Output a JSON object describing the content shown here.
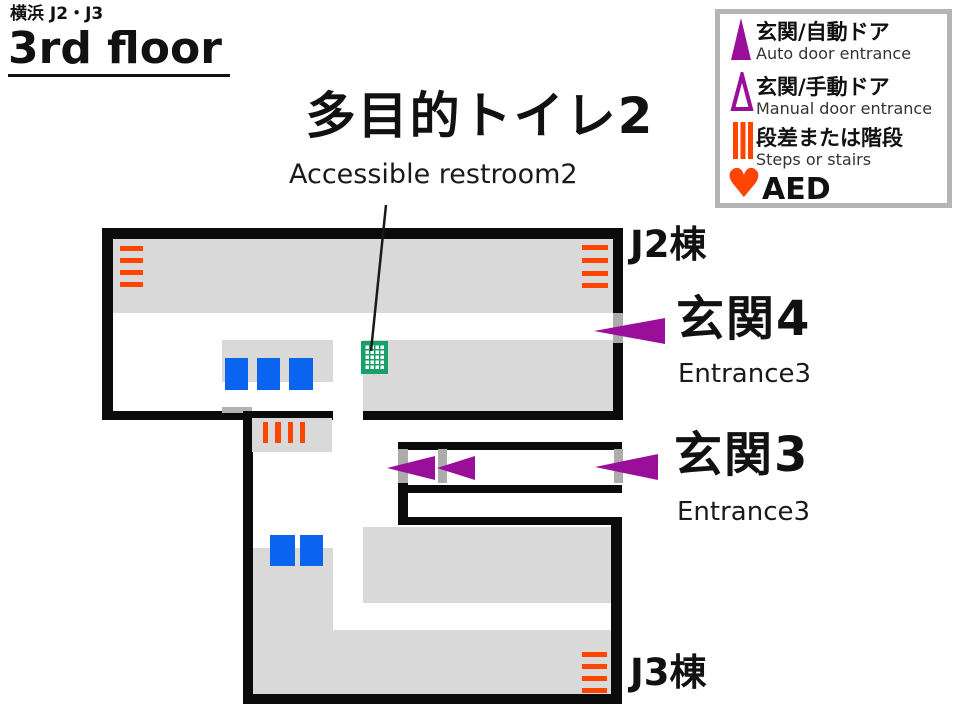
{
  "header": {
    "area_label": "横浜 J2・J3",
    "floor_title": "3rd floor"
  },
  "legend": {
    "auto_door": {
      "jp": "玄関/自動ドア",
      "en": "Auto door entrance"
    },
    "manual_door": {
      "jp": "玄関/手動ドア",
      "en": "Manual door entrance"
    },
    "steps": {
      "jp": "段差または階段",
      "en": "Steps or stairs"
    },
    "aed": {
      "label": "AED"
    }
  },
  "callout": {
    "jp": "多目的トイレ2",
    "en": "Accessible restroom2"
  },
  "map": {
    "j2_label": "J2棟",
    "j3_label": "J3棟",
    "entrance4": {
      "jp": "玄関4",
      "en": "Entrance3"
    },
    "entrance3": {
      "jp": "玄関3",
      "en": "Entrance3"
    }
  },
  "icons": {
    "aed_heart": "♥"
  },
  "colors": {
    "entrance_purple": "#9A0F9A",
    "stairs_orange": "#FF4500",
    "facility_blue": "#0A64F0",
    "restroom_green": "#18A06B",
    "room_gray": "#D9D9D9",
    "door_gray": "#ACACAC",
    "wall_black": "#0B0B0B",
    "legend_border_gray": "#B5B5B5"
  }
}
